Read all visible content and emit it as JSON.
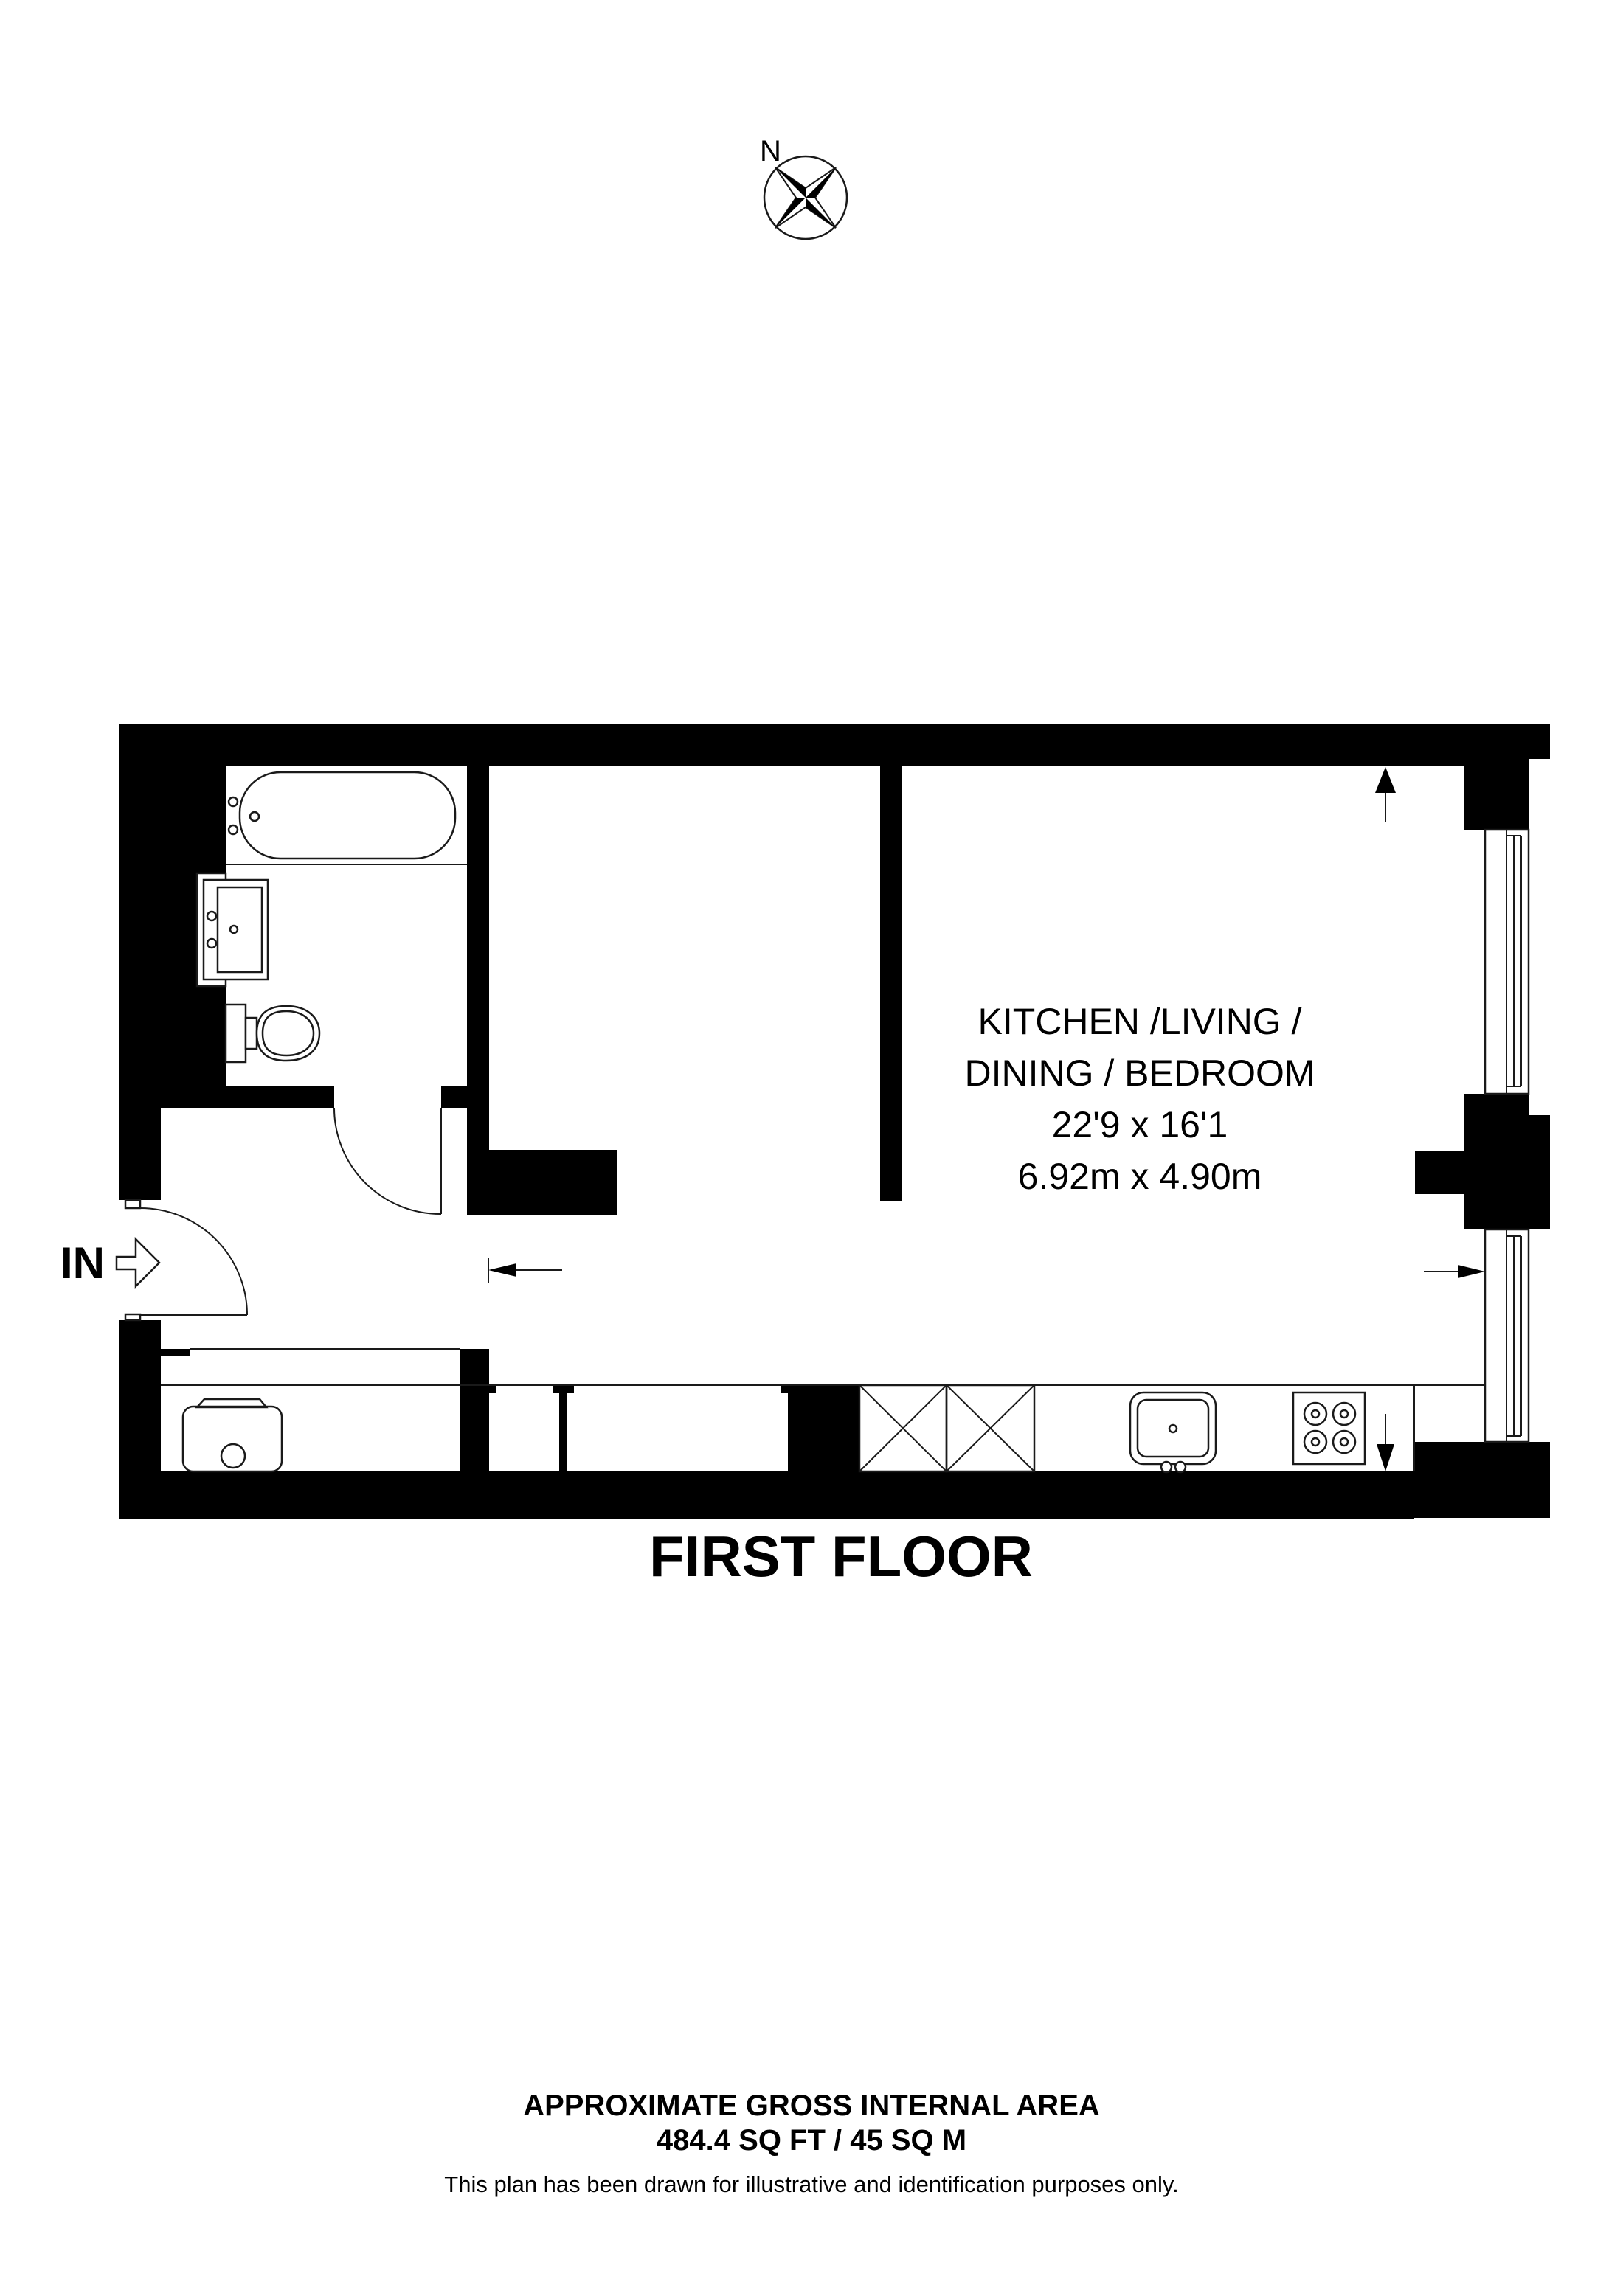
{
  "compass": {
    "north_label": "N"
  },
  "floor_plan": {
    "entrance_label": "IN",
    "room_label": {
      "line1": "KITCHEN /LIVING /",
      "line2": "DINING / BEDROOM",
      "dims_imperial": "22'9 x 16'1",
      "dims_metric": "6.92m x 4.90m"
    },
    "floor_title": "FIRST FLOOR"
  },
  "footer": {
    "area_heading": "APPROXIMATE GROSS INTERNAL AREA",
    "area_value": "484.4 SQ FT / 45 SQ M",
    "disclaimer": "This plan has been drawn for illustrative and identification purposes only."
  },
  "colors": {
    "wall": "#000000",
    "line": "#1a1a1a",
    "background": "#ffffff"
  }
}
